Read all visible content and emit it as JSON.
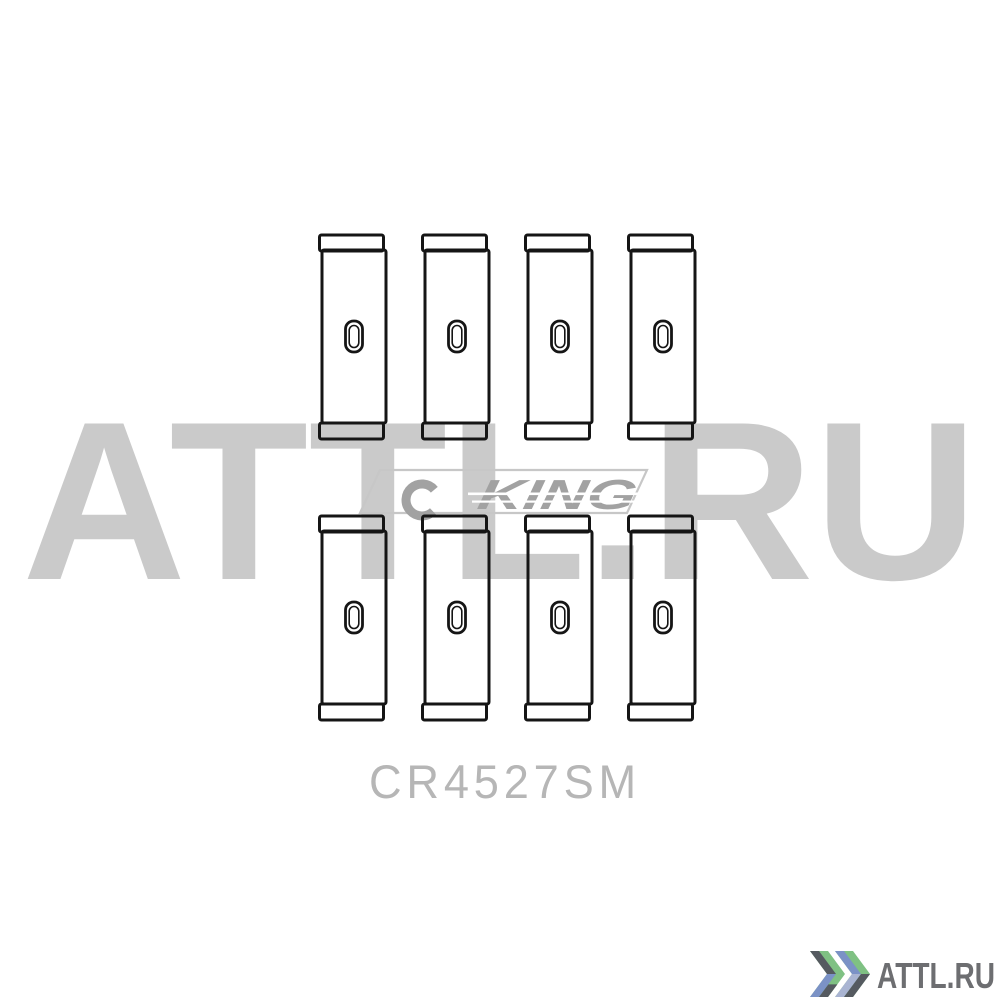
{
  "product": {
    "part_number": "CR4527SM",
    "item": "engine bearing shell set (line drawing)",
    "bearing_rows": 2,
    "bearings_per_row": 4,
    "bearing_count": 8
  },
  "brand": {
    "text": "KING"
  },
  "watermark": {
    "text": "ATTL.RU"
  },
  "site": {
    "text": "ATTL.RU"
  },
  "colors": {
    "line": "#151515",
    "watermark_gray": "#cacaca",
    "brand_gray": "#a2a2a2",
    "frame_gray": "#c7c7c7",
    "part_number_gray": "#b6b6b6",
    "site_text_gray": "#6d6e71",
    "chevron_green": "#7fc183",
    "chevron_blue": "#7b92c6",
    "chevron_pale_blue": "#a9b4d2",
    "chevron_dark": "#555a60",
    "slit_white": "#ffffff"
  }
}
